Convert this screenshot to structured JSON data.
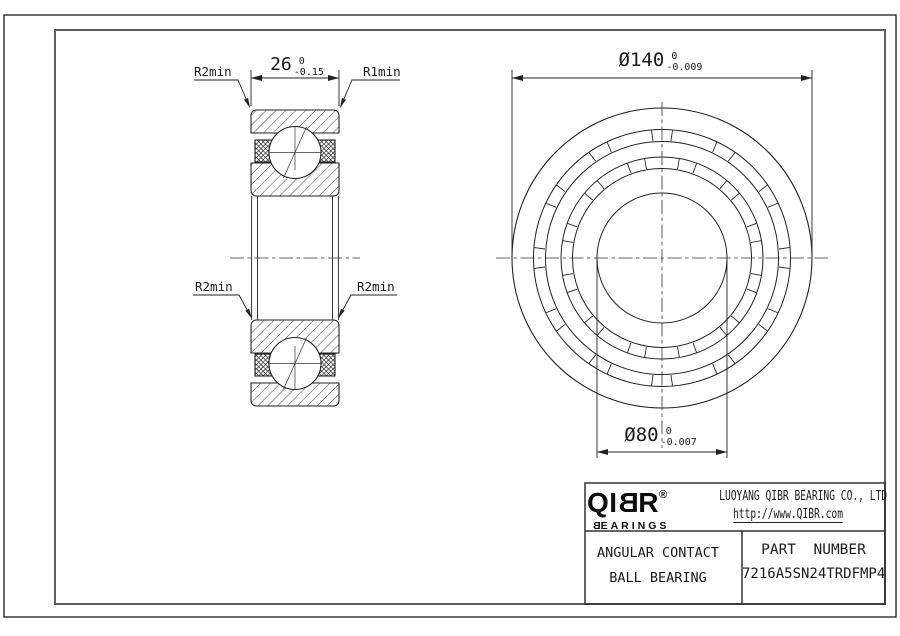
{
  "drawing": {
    "section_view": {
      "label_top_left": "R2min",
      "label_top_right": "R1min",
      "label_mid_left": "R2min",
      "label_mid_right": "R2min",
      "width_dim": {
        "value": "26",
        "tol_upper": "0",
        "tol_lower": "-0.15"
      }
    },
    "front_view": {
      "outer_diameter_dim": {
        "value": "Ø140",
        "tol_upper": "0",
        "tol_lower": "-0.009"
      },
      "bore_diameter_dim": {
        "value": "Ø80",
        "tol_upper": "0",
        "tol_lower": "-0.007"
      }
    }
  },
  "title_block": {
    "logo": {
      "letter_q": "Q",
      "letter_i": "I",
      "letter_b": "B",
      "letter_r": "R",
      "registered_mark": "®",
      "subtitle_b": "B",
      "subtitle_rest": "EARINGS"
    },
    "company_name": "LUOYANG QIBR BEARING CO., LTD",
    "website": "http://www.QIBR.com",
    "product_name_line1": "ANGULAR CONTACT",
    "product_name_line2": "BALL BEARING",
    "part_number_label": "PART  NUMBER",
    "part_number": "7216A5SN24TRDFMP4"
  }
}
